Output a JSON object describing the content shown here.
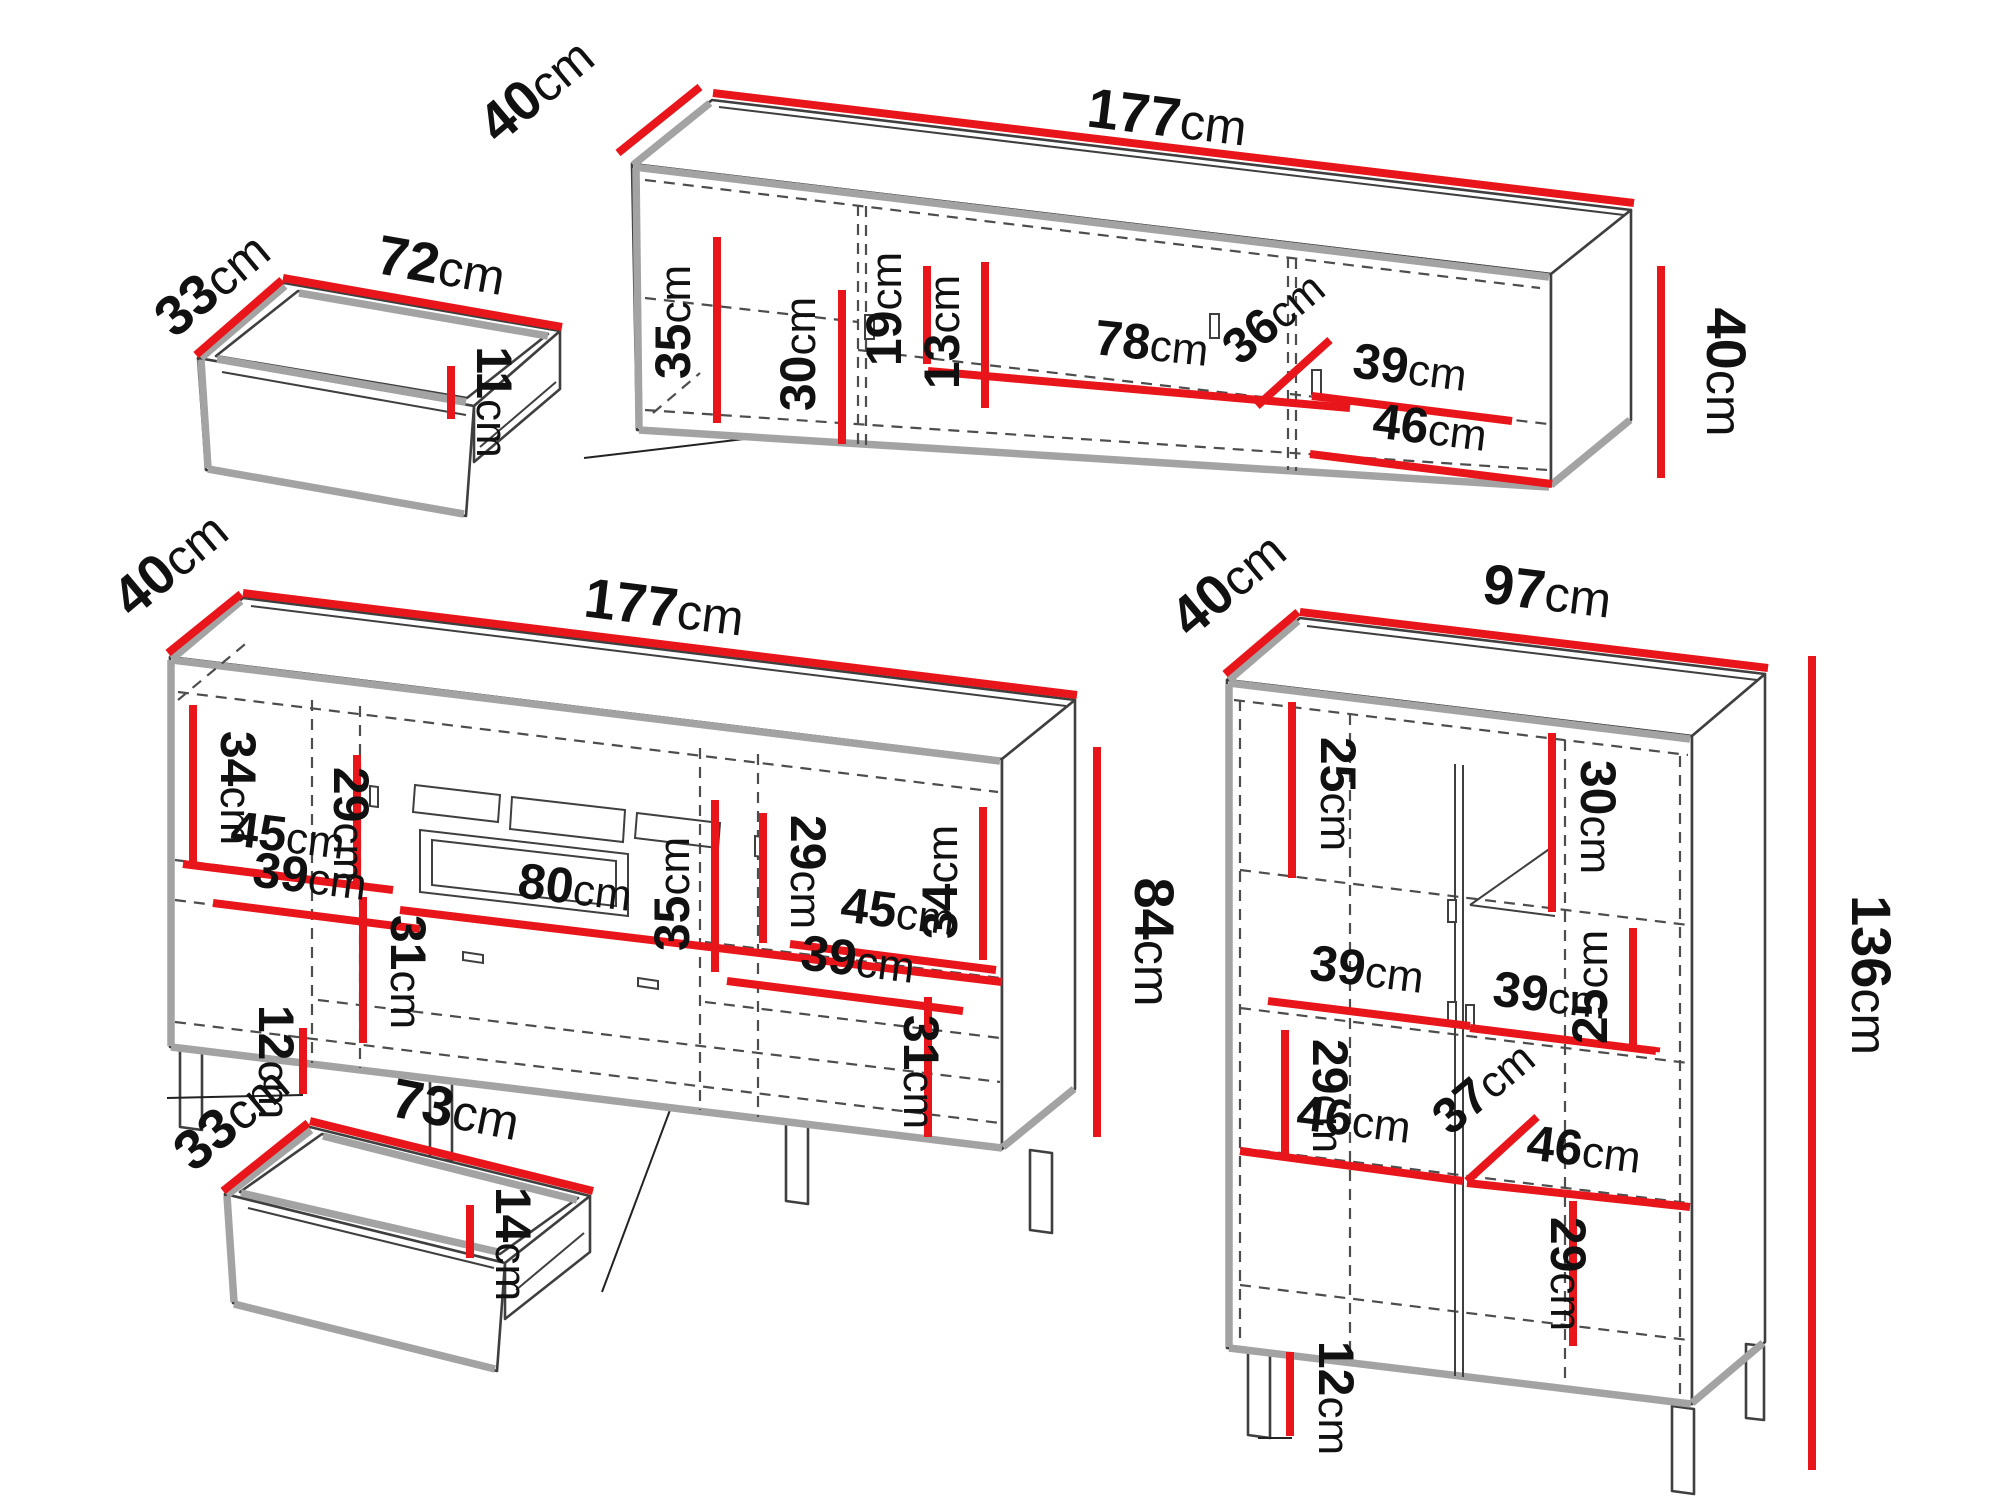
{
  "canvas": {
    "background": "#ffffff"
  },
  "colors": {
    "dimension_line": "#e8151b",
    "drawing_line": "#3f3f3f",
    "shadow_gray": "#a3a3a3",
    "text": "#111111"
  },
  "pieces": {
    "small_drawer_top": {
      "dims": {
        "depth": {
          "value": "33",
          "unit": "cm"
        },
        "width": {
          "value": "72",
          "unit": "cm"
        },
        "front_height": {
          "value": "11",
          "unit": "cm"
        }
      }
    },
    "tv_stand": {
      "dims": {
        "depth": {
          "value": "40",
          "unit": "cm"
        },
        "width": {
          "value": "177",
          "unit": "cm"
        },
        "height": {
          "value": "40",
          "unit": "cm"
        },
        "left_section_height": {
          "value": "35",
          "unit": "cm"
        },
        "door_height": {
          "value": "30",
          "unit": "cm"
        },
        "niche_height_back": {
          "value": "19",
          "unit": "cm"
        },
        "niche_height_front": {
          "value": "13",
          "unit": "cm"
        },
        "niche_width": {
          "value": "78",
          "unit": "cm"
        },
        "right_section_depth": {
          "value": "36",
          "unit": "cm"
        },
        "right_shelf_upper": {
          "value": "39",
          "unit": "cm"
        },
        "right_shelf_lower": {
          "value": "46",
          "unit": "cm"
        }
      }
    },
    "sideboard": {
      "dims": {
        "depth": {
          "value": "40",
          "unit": "cm"
        },
        "width": {
          "value": "177",
          "unit": "cm"
        },
        "height": {
          "value": "84",
          "unit": "cm"
        },
        "left_upper_height": {
          "value": "34",
          "unit": "cm"
        },
        "left_inner_height": {
          "value": "29",
          "unit": "cm"
        },
        "left_shelf_upper": {
          "value": "45",
          "unit": "cm"
        },
        "left_shelf_lower": {
          "value": "39",
          "unit": "cm"
        },
        "left_lower_height": {
          "value": "31",
          "unit": "cm"
        },
        "leg_height": {
          "value": "12",
          "unit": "cm"
        },
        "center_width": {
          "value": "80",
          "unit": "cm"
        },
        "center_height": {
          "value": "35",
          "unit": "cm"
        },
        "right_inner_height": {
          "value": "29",
          "unit": "cm"
        },
        "right_upper_height": {
          "value": "34",
          "unit": "cm"
        },
        "right_shelf_upper": {
          "value": "45",
          "unit": "cm"
        },
        "right_shelf_lower": {
          "value": "39",
          "unit": "cm"
        },
        "right_lower_height": {
          "value": "31",
          "unit": "cm"
        }
      }
    },
    "large_drawer_bottom": {
      "dims": {
        "depth": {
          "value": "33",
          "unit": "cm"
        },
        "width": {
          "value": "73",
          "unit": "cm"
        },
        "front_height": {
          "value": "14",
          "unit": "cm"
        }
      }
    },
    "tall_cabinet": {
      "dims": {
        "depth": {
          "value": "40",
          "unit": "cm"
        },
        "width": {
          "value": "97",
          "unit": "cm"
        },
        "height": {
          "value": "136",
          "unit": "cm"
        },
        "top_left_height": {
          "value": "25",
          "unit": "cm"
        },
        "top_right_height": {
          "value": "30",
          "unit": "cm"
        },
        "mid_right_height": {
          "value": "25",
          "unit": "cm"
        },
        "shelf_left": {
          "value": "39",
          "unit": "cm"
        },
        "shelf_right": {
          "value": "39",
          "unit": "cm"
        },
        "mid_left_height": {
          "value": "29",
          "unit": "cm"
        },
        "lower_shelf_left": {
          "value": "46",
          "unit": "cm"
        },
        "inner_depth": {
          "value": "37",
          "unit": "cm"
        },
        "lower_shelf_right": {
          "value": "46",
          "unit": "cm"
        },
        "bottom_right_height": {
          "value": "29",
          "unit": "cm"
        },
        "leg_height": {
          "value": "12",
          "unit": "cm"
        }
      }
    }
  }
}
